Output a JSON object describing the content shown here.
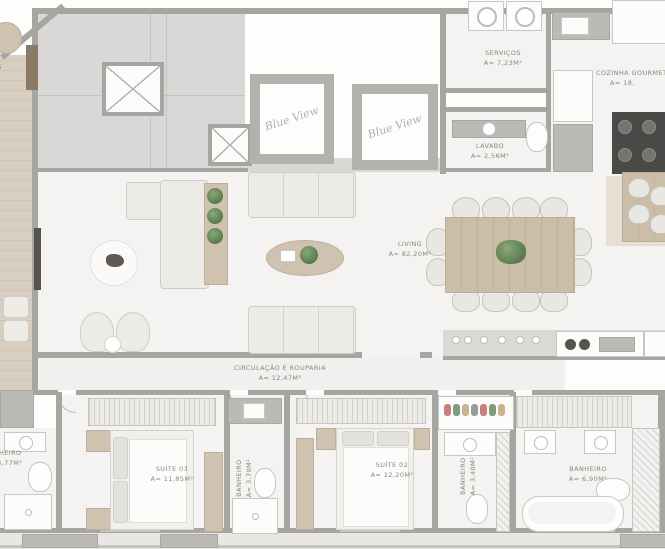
{
  "plan": {
    "elevator_logo": {
      "line1": "Blue",
      "line2": "View"
    },
    "rooms": [
      {
        "name": "LIVING",
        "area": "A= 82,20m²"
      },
      {
        "name": "SERVIÇOS",
        "area": "A= 7,23m²"
      },
      {
        "name": "LAVABO",
        "area": "A= 2,56m²"
      },
      {
        "name": "COZINHA GOURMET",
        "area": "A= 18,"
      },
      {
        "name": "CIRCULAÇÃO E ROUPARIA",
        "area": "A= 12,47m²"
      },
      {
        "name": "SUÍTE 03",
        "area": "A= 11,85m²"
      },
      {
        "name": "SUÍTE 02",
        "area": "A= 12,20m²"
      },
      {
        "name": "BANHEIRO",
        "area": "A= 3,77m²"
      },
      {
        "name": "BANHEIRO",
        "area": "A= 3,70m²"
      },
      {
        "name": "BANHEIRO",
        "area": "A= 3,40m²"
      },
      {
        "name": "BANHEIRO",
        "area": "A= 6,90m²"
      },
      {
        "name": "DELOS",
        "area": "m²"
      }
    ],
    "colors": {
      "wall": "#a7a5a1",
      "floor": "#f4f3f1",
      "core_floor": "#d9d8d6",
      "wood": "#cfc2b0",
      "plant_green": "#5a7a4e",
      "label_text": "#8a867f"
    }
  }
}
